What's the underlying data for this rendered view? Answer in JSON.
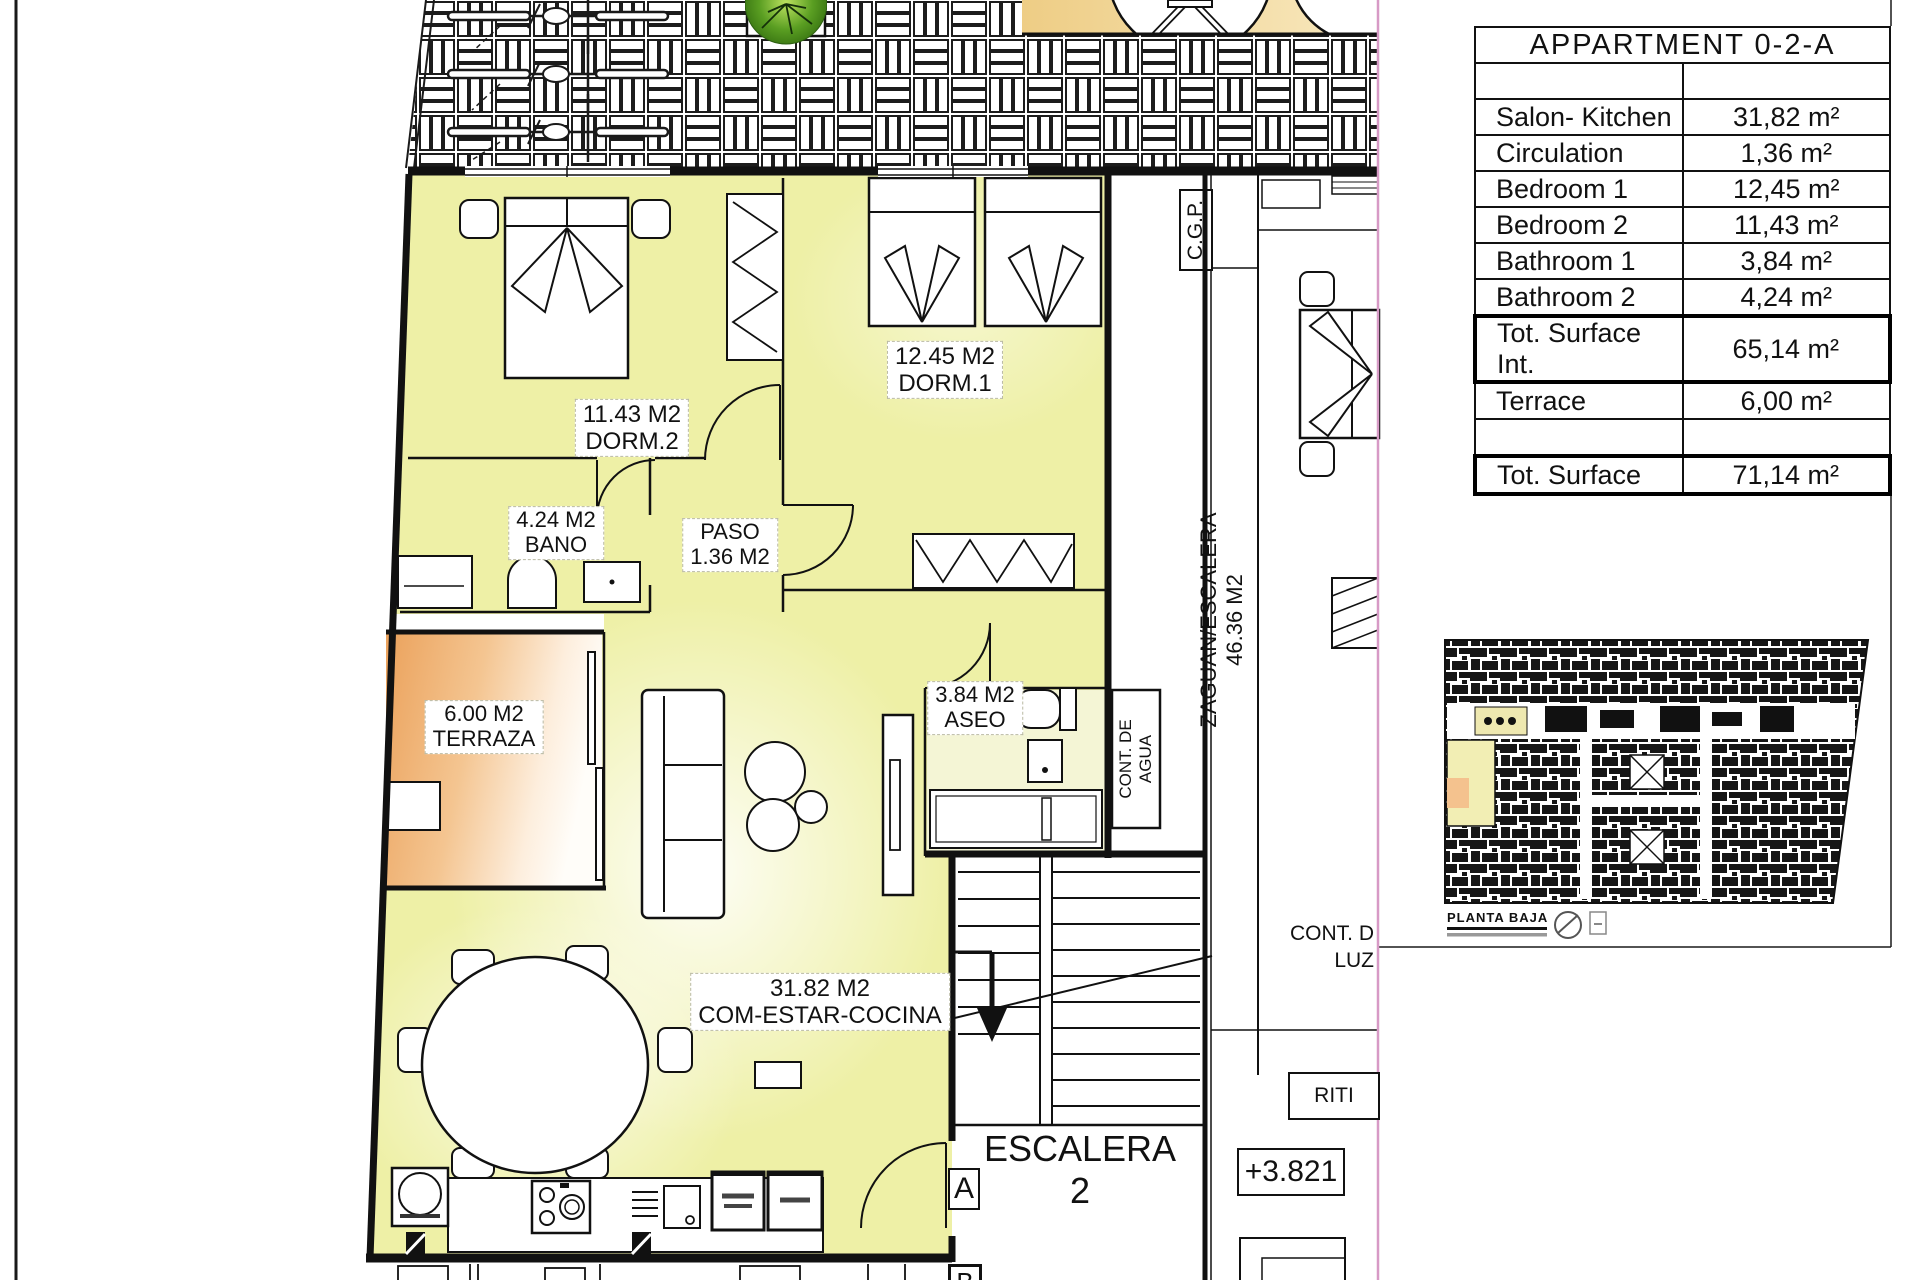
{
  "legend_table": {
    "title": "APPARTMENT 0-2-A",
    "rows": [
      {
        "label": "",
        "value": ""
      },
      {
        "label": "Salon- Kitchen",
        "value": "31,82 m²"
      },
      {
        "label": "Circulation",
        "value": "1,36 m²"
      },
      {
        "label": "Bedroom 1",
        "value": "12,45 m²"
      },
      {
        "label": "Bedroom 2",
        "value": "11,43 m²"
      },
      {
        "label": "Bathroom 1",
        "value": "3,84 m²"
      },
      {
        "label": "Bathroom 2",
        "value": "4,24 m²"
      },
      {
        "label": "Tot. Surface Int.",
        "value": "65,14 m²"
      },
      {
        "label": "Terrace",
        "value": "6,00 m²"
      },
      {
        "label": "",
        "value": ""
      },
      {
        "label": "Tot. Surface",
        "value": "71,14 m²"
      }
    ]
  },
  "plan": {
    "rooms": {
      "dorm2": {
        "line1": "11.43 M2",
        "line2": "DORM.2"
      },
      "dorm1": {
        "line1": "12.45 M2",
        "line2": "DORM.1"
      },
      "bano": {
        "line1": "4.24 M2",
        "line2": "BANO"
      },
      "paso": {
        "line1": "PASO",
        "line2": "1.36 M2"
      },
      "terraza": {
        "line1": "6.00 M2",
        "line2": "TERRAZA"
      },
      "aseo": {
        "line1": "3.84 M2",
        "line2": "ASEO"
      },
      "comestar": {
        "line1": "31.82 M2",
        "line2": "COM-ESTAR-COCINA"
      }
    },
    "common": {
      "zaguan_line1": "ZAGUAN/ESCALERA",
      "zaguan_line2": "46.36 M2",
      "cgp": "C.G.P.",
      "cont_agua_line1": "CONT. DE",
      "cont_agua_line2": "AGUA",
      "cont_luz_line1": "CONT. D",
      "cont_luz_line2": "LUZ",
      "riti": "RITI",
      "escalera": "ESCALERA 2",
      "level": "+3.821",
      "entry_a": "A",
      "entry_b": "B"
    },
    "miniplan_caption": "PLANTA BAJA"
  },
  "colors": {
    "room_fill": "#eef0a6",
    "terrace_orange": "#eca763",
    "patio_band": "#f1d493",
    "tree_green": "#5a9e22",
    "crop_line": "#d79ac6",
    "miniplan_highlight": "#f2eeb4"
  }
}
